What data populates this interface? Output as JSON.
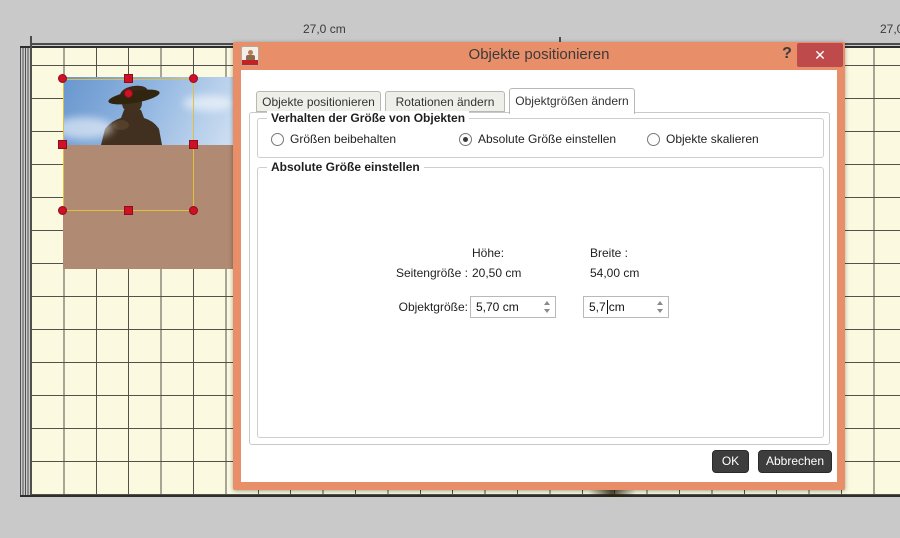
{
  "colors": {
    "accent_orange": "#E88E69",
    "close_red": "#BF4A4B",
    "button_dark": "#3D3D3D",
    "handle_red": "#CE1126",
    "selection_gold": "#E3BE3C",
    "grid_paper": "#FBFAE0"
  },
  "ruler": {
    "left_label": "27,0 cm",
    "right_label": "27,0 cm"
  },
  "dialog": {
    "title": "Objekte positionieren",
    "help_label": "?",
    "close_label": "✕",
    "tabs": [
      {
        "label": "Objekte positionieren",
        "active": false
      },
      {
        "label": "Rotationen ändern",
        "active": false
      },
      {
        "label": "Objektgrößen ändern",
        "active": true
      }
    ],
    "behavior_group": {
      "title": "Verhalten der Größe von Objekten",
      "options": [
        {
          "label": "Größen beibehalten",
          "selected": false
        },
        {
          "label": "Absolute Größe einstellen",
          "selected": true
        },
        {
          "label": "Objekte skalieren",
          "selected": false
        }
      ]
    },
    "size_group": {
      "title": "Absolute Größe einstellen",
      "col_height": "Höhe:",
      "col_width": "Breite :",
      "page_size_label": "Seitengröße :",
      "page_height_value": "20,50 cm",
      "page_width_value": "54,00 cm",
      "object_size_label": "Objektgröße:",
      "object_height_value": "5,70 cm",
      "object_width_value": "5,7",
      "object_width_suffix": "cm"
    },
    "buttons": {
      "ok": "OK",
      "cancel": "Abbrechen"
    }
  }
}
